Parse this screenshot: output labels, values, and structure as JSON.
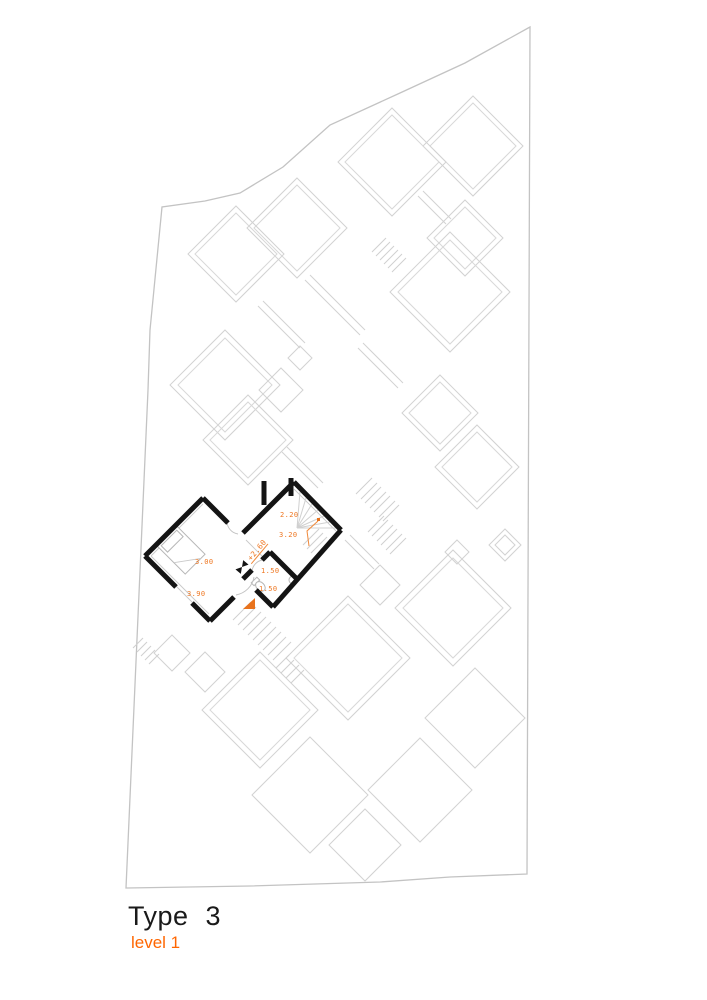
{
  "page": {
    "title": "Type 3",
    "subtitle": "level 1"
  },
  "plan": {
    "unit": {
      "name": "type-3-unit",
      "level_marker": "+2.60",
      "dimensions": [
        "2.20",
        "3.20",
        "3.00",
        "3.90",
        "1.50",
        "1.50"
      ]
    },
    "colors": {
      "wall": "#141414",
      "dimension_text": "#ee7722",
      "subtitle_text": "#ff6600",
      "entrance_marker": "#e8731e",
      "site_outline": "#d2d2d2",
      "boundary": "#c3c3c3"
    }
  }
}
